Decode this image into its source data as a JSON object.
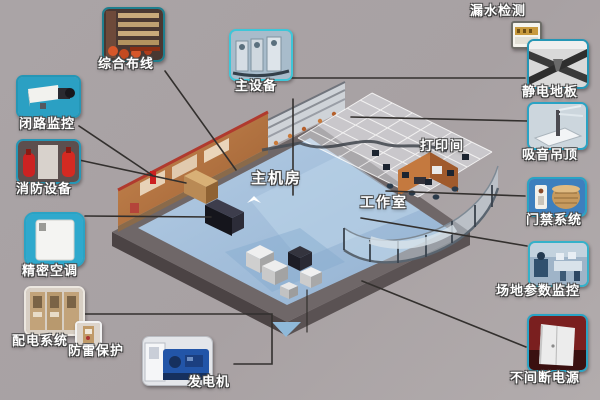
{
  "diagram_type": "machine-room infrastructure callout diagram",
  "components": {
    "cabling": {
      "label": "综合布线"
    },
    "cctv": {
      "label": "闭路监控"
    },
    "fire": {
      "label": "消防设备"
    },
    "precision_ac": {
      "label": "精密空调"
    },
    "power_dist": {
      "label": "配电系统"
    },
    "lightning": {
      "label": "防雷保护"
    },
    "generator": {
      "label": "发电机"
    },
    "main_equipment": {
      "label": "主设备"
    },
    "leak_detection": {
      "label": "漏水检测"
    },
    "antistatic_floor": {
      "label": "静电地板"
    },
    "acoustic_ceiling": {
      "label": "吸音吊顶"
    },
    "access_control": {
      "label": "门禁系统"
    },
    "site_monitoring": {
      "label": "场地参数监控"
    },
    "ups": {
      "label": "不间断电源"
    }
  },
  "rooms": {
    "main_room": {
      "label": "主机房"
    },
    "workroom": {
      "label": "工作室"
    },
    "print_room": {
      "label": "打印间"
    }
  },
  "colors": {
    "background": "#a8a2a4",
    "callout_border_teal": "#2aa3c4",
    "label_text": "#ffffff",
    "leader_line": "#33302e",
    "floor_blue": "#a3bedb",
    "wall_brown": "#b4713f",
    "slab_gray": "#6f6768"
  }
}
